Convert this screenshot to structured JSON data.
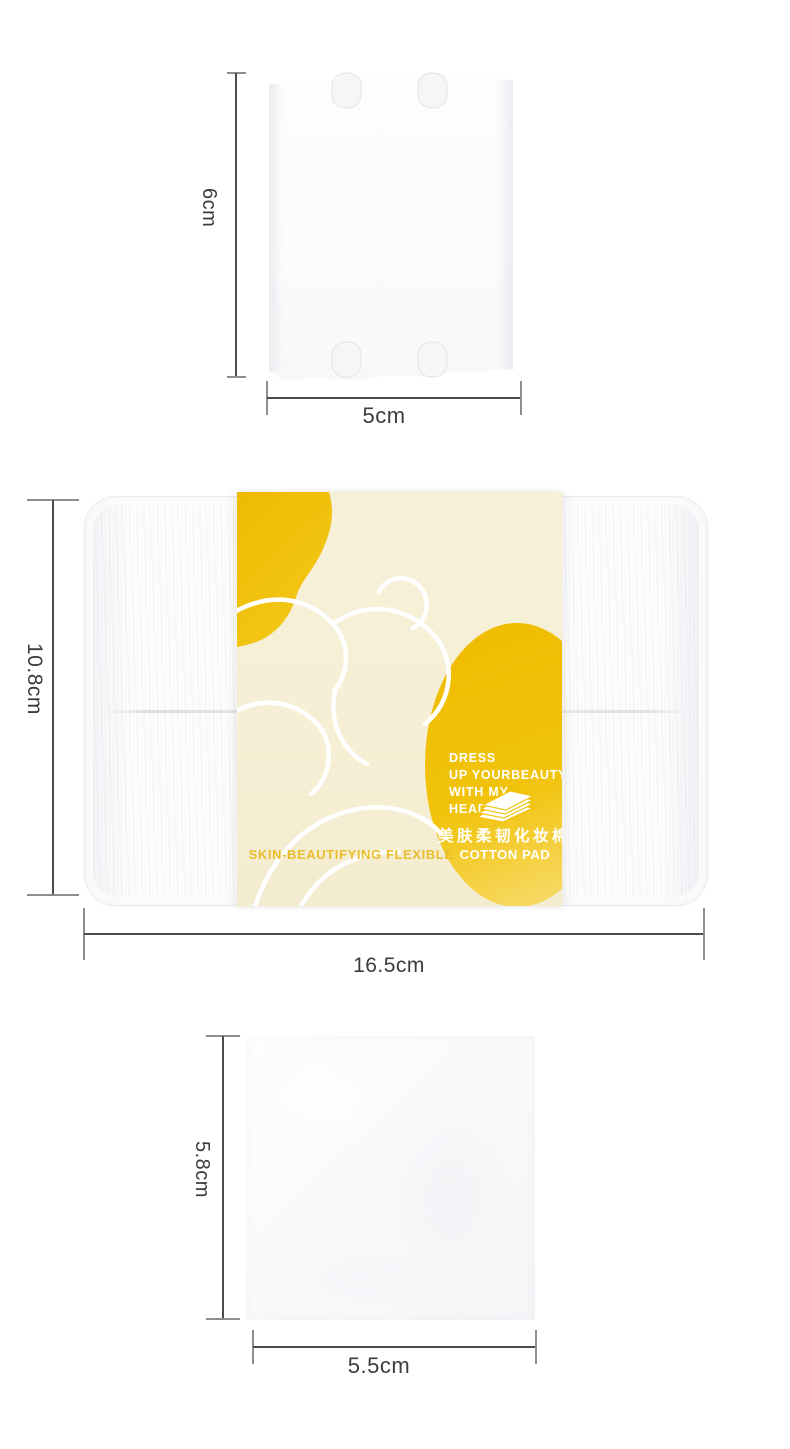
{
  "colors": {
    "accent_yellow": "#f2c104",
    "label_cream": "#f6efd6",
    "gold_text": "#e9bd2b",
    "dimension_line": "#4b4b4b",
    "dimension_text": "#3c3c3c"
  },
  "top_pad": {
    "height_label": "6cm",
    "width_label": "5cm"
  },
  "package": {
    "height_label": "10.8cm",
    "width_label": "16.5cm",
    "slogan_lines": [
      "DRESS",
      "UP YOURBEAUTY",
      "WITH MY",
      "HEART"
    ],
    "product_name_zh": "美肤柔韧化妆棉",
    "product_name_en_part1": "SKIN-BEAUTIFYING FLEXIBLE",
    "product_name_en_part2": "COTTON PAD"
  },
  "bottom_pad": {
    "height_label": "5.8cm",
    "width_label": "5.5cm"
  },
  "icons": {
    "pad_stack": "cotton-pad-stack-icon"
  }
}
